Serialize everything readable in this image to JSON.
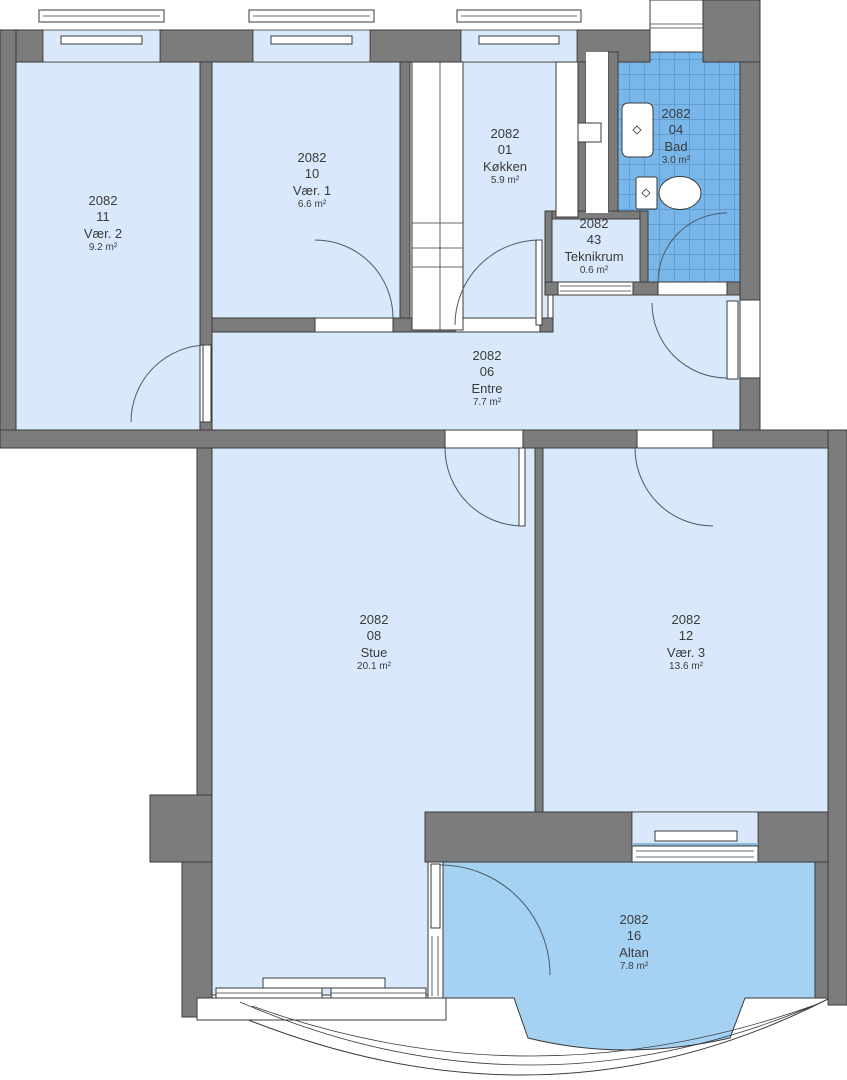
{
  "plan_title": "Apartment floor plan 2082",
  "palette": {
    "wall": "#7c7c7c",
    "wall-outline": "#3a3a3a",
    "room": "#d9e9fb",
    "balcony": "#a5d2f3",
    "tile": "#79b6e9",
    "tile-line": "#4d88bd",
    "line": "#3a3a3a",
    "text": "#3b3b3b",
    "bg": "#ffffff"
  },
  "rooms": [
    {
      "key": "vaer2",
      "id": "2082",
      "number": "11",
      "name": "Vær. 2",
      "area": "9.2 m²"
    },
    {
      "key": "vaer1",
      "id": "2082",
      "number": "10",
      "name": "Vær. 1",
      "area": "6.6 m²"
    },
    {
      "key": "koekken",
      "id": "2082",
      "number": "01",
      "name": "Køkken",
      "area": "5.9 m²"
    },
    {
      "key": "bad",
      "id": "2082",
      "number": "04",
      "name": "Bad",
      "area": "3.0 m²"
    },
    {
      "key": "teknikrum",
      "id": "2082",
      "number": "43",
      "name": "Teknikrum",
      "area": "0.6 m²"
    },
    {
      "key": "entre",
      "id": "2082",
      "number": "06",
      "name": "Entre",
      "area": "7.7 m²"
    },
    {
      "key": "stue",
      "id": "2082",
      "number": "08",
      "name": "Stue",
      "area": "20.1 m²"
    },
    {
      "key": "vaer3",
      "id": "2082",
      "number": "12",
      "name": "Vær. 3",
      "area": "13.6 m²"
    },
    {
      "key": "altan",
      "id": "2082",
      "number": "16",
      "name": "Altan",
      "area": "7.8 m²"
    }
  ]
}
